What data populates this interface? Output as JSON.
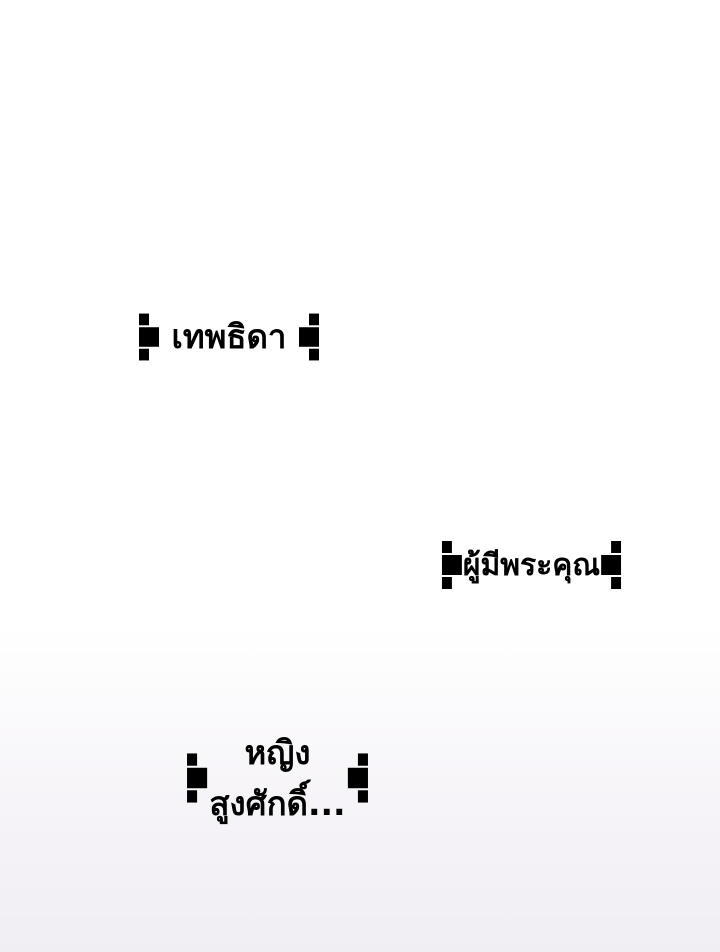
{
  "page": {
    "kind": "comic-webtoon-panel",
    "background_top": "#ffffff",
    "background_bottom": "#f1eef3"
  },
  "frame_style": {
    "stroke_color": "#262626",
    "text_color": "#000000",
    "ornament": "double-line frame with crossed corner knots and greek-key side medallions"
  },
  "captions": [
    {
      "lines": [
        "เทพธิดา"
      ]
    },
    {
      "lines": [
        "ผู้มีพระคุณ"
      ]
    },
    {
      "lines": [
        "หญิง",
        "สูงศักดิ์..."
      ]
    }
  ]
}
